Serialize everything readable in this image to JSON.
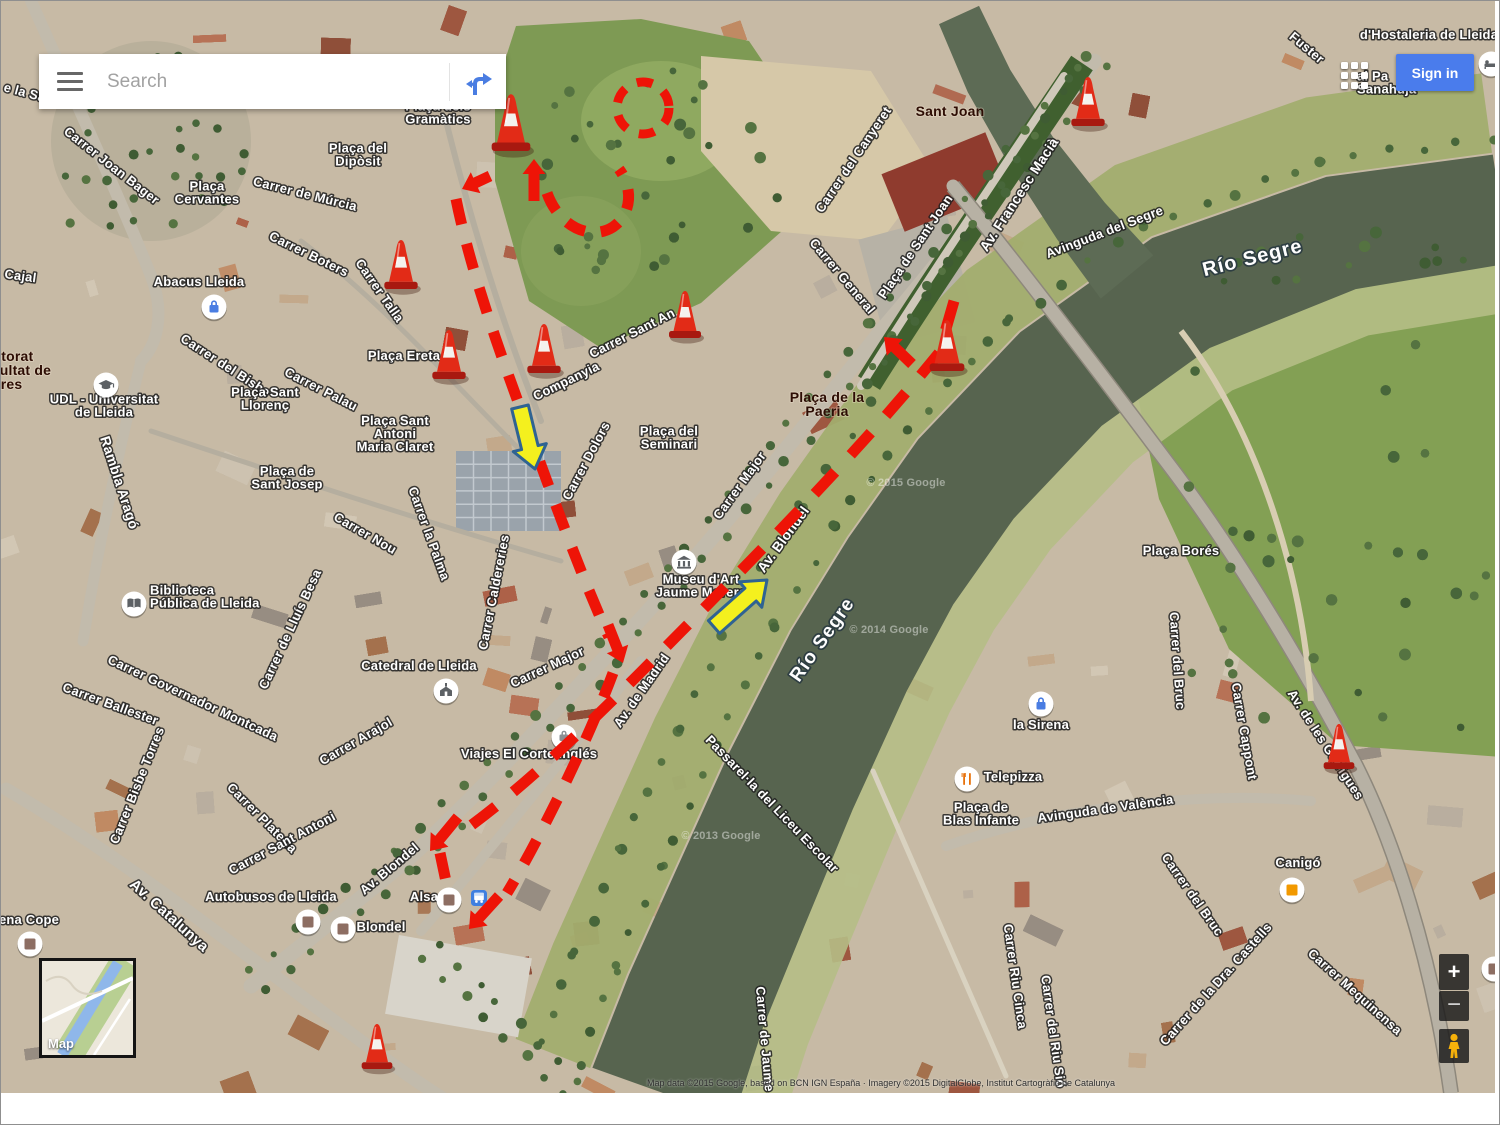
{
  "chrome": {
    "search": {
      "placeholder": "Search"
    },
    "sign_in_label": "Sign in",
    "zoom_in": "+",
    "zoom_out": "−",
    "minimap_label": "Map",
    "attribution": "Map data ©2015 Google, based on BCN IGN España · Imagery ©2015 DigitalGlobe, Institut Cartogràfic de Catalunya",
    "colors": {
      "signin_bg": "#4a7cec",
      "signin_text": "#ffffff"
    }
  },
  "map": {
    "colors": {
      "route": "#ee1407",
      "arrow_yellow": "#f4f01e",
      "arrow_outline": "#2f6392",
      "cone": "#e22b17"
    },
    "street_labels": [
      {
        "text": "e la Sa",
        "x": 2,
        "y": 90,
        "rot": 15,
        "anchor": "start"
      },
      {
        "text": "Carrer Joan Bager",
        "x": 108,
        "y": 168,
        "rot": 38
      },
      {
        "text": "Cajal",
        "x": 3,
        "y": 277,
        "rot": 8,
        "anchor": "start"
      },
      {
        "text": "Carrer de Múrcia",
        "x": 303,
        "y": 197,
        "rot": 14
      },
      {
        "text": "Carrer Boters",
        "x": 306,
        "y": 257,
        "rot": 26
      },
      {
        "text": "Carrer Talla",
        "x": 375,
        "y": 292,
        "rot": 55
      },
      {
        "text": "Carrer del Bisbe",
        "x": 222,
        "y": 368,
        "rot": 33
      },
      {
        "text": "Carrer Palau",
        "x": 318,
        "y": 392,
        "rot": 27
      },
      {
        "text": "Rambla Aragó",
        "x": 114,
        "y": 483,
        "rot": 72,
        "size": 14
      },
      {
        "text": "Carrer Sant An",
        "x": 633,
        "y": 336,
        "rot": -27
      },
      {
        "text": "Companyia",
        "x": 567,
        "y": 384,
        "rot": -26
      },
      {
        "text": "Carrer Caldereries",
        "x": 497,
        "y": 592,
        "rot": -79
      },
      {
        "text": "Carrer Dolors",
        "x": 589,
        "y": 462,
        "rot": -62
      },
      {
        "text": "Carrer Major",
        "x": 742,
        "y": 487,
        "rot": -54
      },
      {
        "text": "Carrer Major",
        "x": 548,
        "y": 670,
        "rot": -25
      },
      {
        "text": "Carrer Nou",
        "x": 362,
        "y": 536,
        "rot": 30
      },
      {
        "text": "Carrer la Palma",
        "x": 424,
        "y": 534,
        "rot": 70
      },
      {
        "text": "Av. Blondel",
        "x": 786,
        "y": 541,
        "rot": -54,
        "size": 14
      },
      {
        "text": "Av. Blondel",
        "x": 391,
        "y": 871,
        "rot": -40
      },
      {
        "text": "Av. de Madrid",
        "x": 644,
        "y": 692,
        "rot": -55
      },
      {
        "text": "Carrer del Canyeret",
        "x": 856,
        "y": 161,
        "rot": -56
      },
      {
        "text": "Plaça de Sant Joan",
        "x": 918,
        "y": 248,
        "rot": -56
      },
      {
        "text": "Carrer General",
        "x": 838,
        "y": 278,
        "rot": 50
      },
      {
        "text": "Av. Francesc Macià",
        "x": 1022,
        "y": 196,
        "rot": -57,
        "size": 14
      },
      {
        "text": "Avinguda del Segre",
        "x": 1105,
        "y": 235,
        "rot": -21,
        "size": 13
      },
      {
        "text": "Carrer Governador Montcada",
        "x": 190,
        "y": 701,
        "rot": 25
      },
      {
        "text": "Carrer Ballester",
        "x": 108,
        "y": 707,
        "rot": 20
      },
      {
        "text": "Carrer de Lluís Besa",
        "x": 293,
        "y": 630,
        "rot": -65
      },
      {
        "text": "Carrer Bisbe Torres",
        "x": 140,
        "y": 786,
        "rot": -68
      },
      {
        "text": "Carrer Plateria",
        "x": 258,
        "y": 820,
        "rot": 45
      },
      {
        "text": "Carrer Sant Antoni",
        "x": 283,
        "y": 846,
        "rot": -28
      },
      {
        "text": "Carrer Arajol",
        "x": 357,
        "y": 744,
        "rot": -30
      },
      {
        "text": "Av. Catalunya",
        "x": 165,
        "y": 918,
        "rot": 42,
        "size": 15
      },
      {
        "text": "Passarel·la del Liceu Escolar",
        "x": 768,
        "y": 806,
        "rot": 46
      },
      {
        "text": "Carrer del Bruc",
        "x": 1172,
        "y": 660,
        "rot": 86
      },
      {
        "text": "Carrer Cappont",
        "x": 1239,
        "y": 731,
        "rot": 80
      },
      {
        "text": "Av. de les Garrigues",
        "x": 1321,
        "y": 746,
        "rot": 57,
        "size": 13
      },
      {
        "text": "Avinguda de València",
        "x": 1105,
        "y": 812,
        "rot": -8,
        "size": 13
      },
      {
        "text": "Carrer del Bruc",
        "x": 1188,
        "y": 896,
        "rot": 55
      },
      {
        "text": "Carrer de la Dra. Castells",
        "x": 1218,
        "y": 986,
        "rot": -48
      },
      {
        "text": "Carrer Mequinensa",
        "x": 1351,
        "y": 994,
        "rot": 42
      },
      {
        "text": "Carrer Riu Cinca",
        "x": 1010,
        "y": 976,
        "rot": 82
      },
      {
        "text": "Carrer del Riu Sió",
        "x": 1048,
        "y": 1031,
        "rot": 82
      },
      {
        "text": "Carrer de Jaume II",
        "x": 760,
        "y": 1044,
        "rot": 85
      },
      {
        "text": "Fuster",
        "x": 1303,
        "y": 50,
        "rot": 40
      }
    ],
    "place_labels": [
      {
        "lines": [
          "Plaça dels",
          "Gramàtics"
        ],
        "x": 437,
        "y": 116
      },
      {
        "lines": [
          "Plaça del",
          "Dipòsit"
        ],
        "x": 357,
        "y": 158
      },
      {
        "lines": [
          "Plaça",
          "Cervantes"
        ],
        "x": 206,
        "y": 196
      },
      {
        "lines": [
          "Abacus Lleida"
        ],
        "x": 198,
        "y": 285
      },
      {
        "lines": [
          "Plaça Ereta"
        ],
        "x": 403,
        "y": 359
      },
      {
        "lines": [
          "Plaça Sant",
          "Llorenç"
        ],
        "x": 264,
        "y": 402
      },
      {
        "lines": [
          "UDL - Universitat",
          "de Lleida"
        ],
        "x": 103,
        "y": 409
      },
      {
        "lines": [
          "Plaça Sant",
          "Antoni",
          "Maria Claret"
        ],
        "x": 394,
        "y": 437
      },
      {
        "lines": [
          "Plaça de",
          "Sant Josep"
        ],
        "x": 286,
        "y": 481
      },
      {
        "lines": [
          "Plaça del",
          "Seminari"
        ],
        "x": 668,
        "y": 441
      },
      {
        "lines": [
          "Biblioteca",
          "Pública de Lleida"
        ],
        "x": 149,
        "y": 600,
        "anchor": "start"
      },
      {
        "lines": [
          "Catedral de Lleida"
        ],
        "x": 418,
        "y": 669
      },
      {
        "lines": [
          "Museu d'Art",
          "Jaume Morera"
        ],
        "x": 700,
        "y": 589
      },
      {
        "lines": [
          "Viajes El Corte Inglés"
        ],
        "x": 528,
        "y": 757
      },
      {
        "lines": [
          "Autobusos de Lleida"
        ],
        "x": 270,
        "y": 900
      },
      {
        "lines": [
          "Alsa"
        ],
        "x": 423,
        "y": 900
      },
      {
        "lines": [
          "Blondel"
        ],
        "x": 380,
        "y": 930
      },
      {
        "lines": [
          "Plaça Borés"
        ],
        "x": 1180,
        "y": 554
      },
      {
        "lines": [
          "la Sirena"
        ],
        "x": 1040,
        "y": 728
      },
      {
        "lines": [
          "Telepizza"
        ],
        "x": 1012,
        "y": 780
      },
      {
        "lines": [
          "Plaça de",
          "Blas Infante"
        ],
        "x": 980,
        "y": 817
      },
      {
        "lines": [
          "Canigó"
        ],
        "x": 1297,
        "y": 866
      },
      {
        "lines": [
          "ena Cope"
        ],
        "x": 28,
        "y": 923
      },
      {
        "lines": [
          "d'Hostaleria de Lleida"
        ],
        "x": 1428,
        "y": 38
      },
      {
        "lines": [
          "al Pa",
          "Sanahuja"
        ],
        "x": 1356,
        "y": 86,
        "anchor": "start"
      }
    ],
    "area_labels": [
      {
        "lines": [
          "Sant Joan"
        ],
        "x": 949,
        "y": 115
      },
      {
        "lines": [
          "Plaça de la",
          "Paeria"
        ],
        "x": 826,
        "y": 408
      },
      {
        "lines": [
          "Rectorat",
          "Facultat de",
          "Lletres"
        ],
        "x": -26,
        "y": 374,
        "anchor": "start"
      }
    ],
    "water_labels": [
      {
        "text": "Río Segre",
        "x": 1253,
        "y": 263,
        "rot": -14,
        "size": 20
      },
      {
        "text": "Río Segre",
        "x": 826,
        "y": 642,
        "rot": -55,
        "size": 19
      }
    ],
    "watermarks": [
      {
        "text": "© 2015 Google",
        "x": 905,
        "y": 485
      },
      {
        "text": "© 2014 Google",
        "x": 888,
        "y": 632
      },
      {
        "text": "© 2013 Google",
        "x": 720,
        "y": 838
      }
    ],
    "poi_icons": [
      {
        "icon": "graduation-cap",
        "x": 105,
        "y": 384,
        "name": "university-icon"
      },
      {
        "icon": "bag",
        "x": 213,
        "y": 306,
        "color": "#4a7de2",
        "name": "shopping-bag-icon"
      },
      {
        "icon": "book",
        "x": 133,
        "y": 603,
        "name": "library-icon"
      },
      {
        "icon": "church",
        "x": 445,
        "y": 690,
        "name": "cathedral-icon"
      },
      {
        "icon": "museum",
        "x": 683,
        "y": 561,
        "name": "museum-icon"
      },
      {
        "icon": "suitcase",
        "x": 563,
        "y": 736,
        "name": "travel-agency-icon"
      },
      {
        "icon": "square",
        "x": 307,
        "y": 921,
        "color": "#8d6e63",
        "name": "generic-poi-icon"
      },
      {
        "icon": "square",
        "x": 448,
        "y": 899,
        "color": "#8d6e63",
        "name": "generic-poi-icon"
      },
      {
        "icon": "transit",
        "x": 478,
        "y": 897,
        "name": "bus-stop-icon"
      },
      {
        "icon": "square",
        "x": 342,
        "y": 928,
        "color": "#8d6e63",
        "name": "generic-poi-icon"
      },
      {
        "icon": "bag",
        "x": 1040,
        "y": 703,
        "color": "#4a7de2",
        "name": "shopping-bag-icon"
      },
      {
        "icon": "restaurant",
        "x": 966,
        "y": 778,
        "color": "#e8710a",
        "name": "restaurant-icon"
      },
      {
        "icon": "square",
        "x": 1291,
        "y": 889,
        "color": "#f29900",
        "name": "generic-poi-icon"
      },
      {
        "icon": "square",
        "x": 29,
        "y": 943,
        "color": "#8d6e63",
        "name": "generic-poi-icon"
      },
      {
        "icon": "bed",
        "x": 1490,
        "y": 63,
        "name": "hotel-icon"
      },
      {
        "icon": "square",
        "x": 1493,
        "y": 968,
        "color": "#8d6e63",
        "name": "generic-poi-icon"
      }
    ],
    "cones": [
      {
        "x": 510,
        "y": 150,
        "h": 58
      },
      {
        "x": 400,
        "y": 288,
        "h": 50
      },
      {
        "x": 448,
        "y": 378,
        "h": 50
      },
      {
        "x": 543,
        "y": 372,
        "h": 50
      },
      {
        "x": 684,
        "y": 337,
        "h": 48
      },
      {
        "x": 946,
        "y": 370,
        "h": 52
      },
      {
        "x": 1087,
        "y": 125,
        "h": 50
      },
      {
        "x": 1338,
        "y": 768,
        "h": 46
      },
      {
        "x": 376,
        "y": 1068,
        "h": 46
      }
    ],
    "routes": [
      {
        "d": "M 455,198 C 468,262 492,332 516,398 C 539,461 576,566 608,636",
        "dash": "26 20"
      },
      {
        "d": "M 612,672 C 597,712 574,764 549,813 C 533,845 517,874 506,892",
        "dash": "26 20"
      },
      {
        "d": "M 953,300 L 938,352 C 850,460 740,570 643,668 C 592,719 523,787 461,831",
        "dash": "30 23"
      },
      {
        "d": "M 439,852 L 447,890",
        "dash": "26 20"
      },
      {
        "d": "M 546,192 C 558,226 590,240 612,226 C 630,214 633,188 618,168",
        "dash": "20 16"
      }
    ],
    "route_circle": {
      "cx": 642,
      "cy": 107,
      "r": 26,
      "dash": "16 13"
    },
    "red_arrows": [
      [
        533,
        200,
        533,
        158
      ],
      [
        489,
        175,
        461,
        188
      ],
      [
        607,
        624,
        622,
        662
      ],
      [
        457,
        816,
        429,
        850
      ],
      [
        498,
        895,
        468,
        928
      ],
      [
        911,
        363,
        883,
        336
      ]
    ],
    "yellow_arrows": [
      [
        519,
        406,
        534,
        468
      ],
      [
        713,
        626,
        766,
        579
      ]
    ]
  }
}
